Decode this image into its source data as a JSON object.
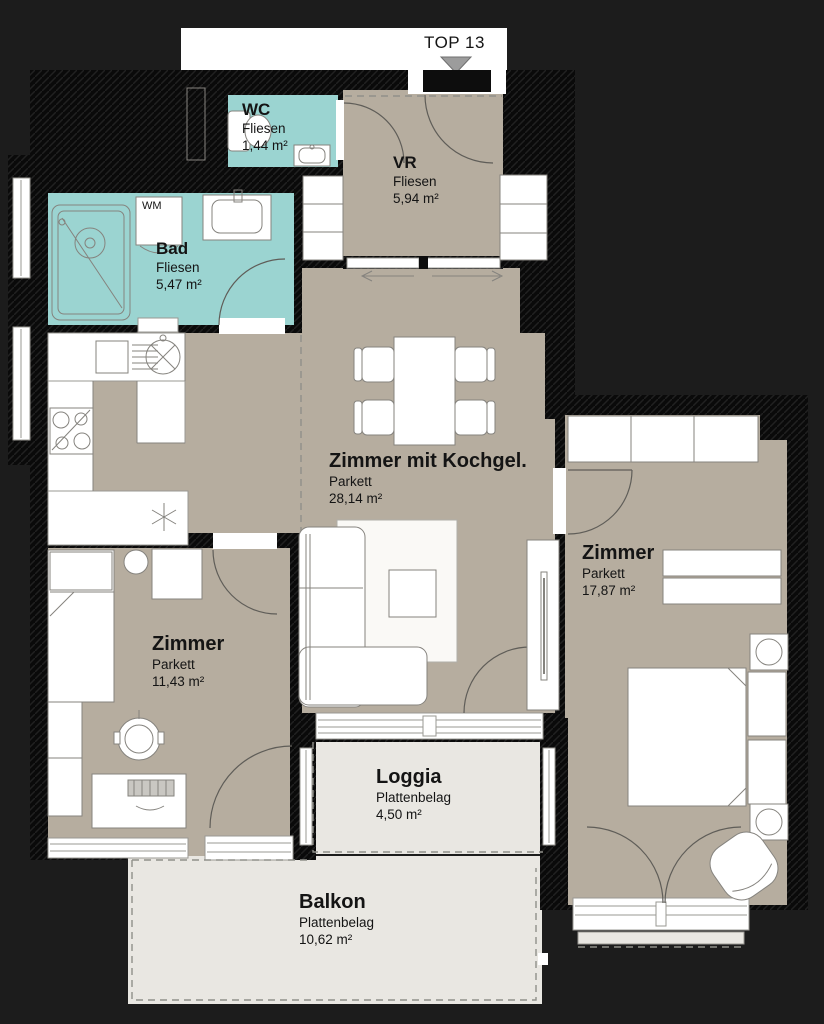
{
  "title": {
    "top_label": "TOP 13"
  },
  "rooms": {
    "wc": {
      "name": "WC",
      "floor": "Fliesen",
      "area": "1,44 m²"
    },
    "bad": {
      "name": "Bad",
      "floor": "Fliesen",
      "area": "5,47 m²",
      "appliance_label": "WM"
    },
    "vr": {
      "name": "VR",
      "floor": "Fliesen",
      "area": "5,94 m²"
    },
    "living_kitchen": {
      "name": "Zimmer mit Kochgel.",
      "floor": "Parkett",
      "area": "28,14 m²"
    },
    "bedroom_right": {
      "name": "Zimmer",
      "floor": "Parkett",
      "area": "17,87 m²"
    },
    "bedroom_left": {
      "name": "Zimmer",
      "floor": "Parkett",
      "area": "11,43 m²"
    },
    "loggia": {
      "name": "Loggia",
      "floor": "Plattenbelag",
      "area": "4,50 m²"
    },
    "balkon": {
      "name": "Balkon",
      "floor": "Plattenbelag",
      "area": "10,62 m²"
    }
  },
  "colors": {
    "background": "#1c1c1c",
    "wall": "#0a0a0a",
    "tile": "#9bd4d1",
    "parquet": "#b6ad9f",
    "outdoor": "#e9e7e2",
    "paper": "#ffffff",
    "dash": "#90908a",
    "text": "#141414",
    "triangle": "#9c9c9c"
  }
}
